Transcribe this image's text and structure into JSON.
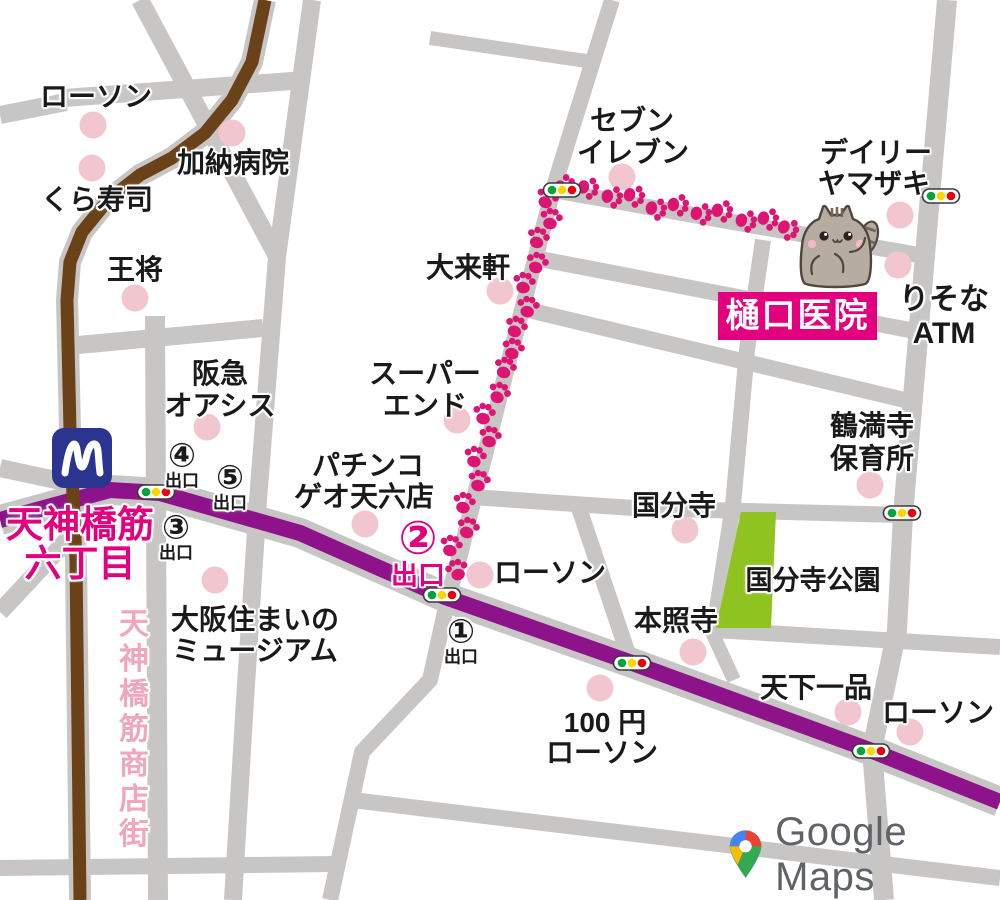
{
  "attribution": {
    "text": "Google Maps"
  },
  "station": {
    "line1": "天神橋筋",
    "line2": "六丁目",
    "metro_logo": "M"
  },
  "clinic": {
    "name": "樋口医院"
  },
  "park": {
    "name": "国分寺公園"
  },
  "arcade": {
    "chars": [
      "天",
      "神",
      "橋",
      "筋",
      "商",
      "店",
      "街"
    ]
  },
  "colors": {
    "road": "#C8C5C5",
    "purple_road": "#8E138B",
    "brown_road": "#6B4117",
    "paw": "#DD1474",
    "accent_pink": "#E3007F",
    "poi_dot": "#F2C6CE",
    "park_green": "#8FC31F",
    "metro_blue": "#2B3590",
    "arcade_pink": "#F0A6BC",
    "light_green": "#00A43B",
    "light_yellow": "#FFD500",
    "light_red": "#E60012",
    "google_gray": "#5F6368",
    "text": "#1A1A1A",
    "cat_body": "#B7ACA2",
    "cat_outline": "#51463C",
    "cat_stripe": "#74685C",
    "cat_cheek": "#F4B9C7"
  },
  "labels": [
    {
      "text": "ローソン",
      "x": 96,
      "y": 97
    },
    {
      "text": "加納病院",
      "x": 233,
      "y": 163
    },
    {
      "text": "くら寿司",
      "x": 97,
      "y": 200
    },
    {
      "text": "王将",
      "x": 135,
      "y": 270
    },
    {
      "text": "阪急",
      "x": 220,
      "y": 374
    },
    {
      "text": "オアシス",
      "x": 220,
      "y": 406
    },
    {
      "text": "スーパー",
      "x": 425,
      "y": 374
    },
    {
      "text": "エンド",
      "x": 425,
      "y": 406
    },
    {
      "text": "パチンコ",
      "x": 368,
      "y": 466
    },
    {
      "text": "ゲオ天六店",
      "x": 364,
      "y": 497
    },
    {
      "text": "大来軒",
      "x": 468,
      "y": 268
    },
    {
      "text": "セブン",
      "x": 632,
      "y": 121
    },
    {
      "text": "イレブン",
      "x": 633,
      "y": 153
    },
    {
      "text": "デイリー",
      "x": 876,
      "y": 153
    },
    {
      "text": "ヤマザキ",
      "x": 874,
      "y": 184
    },
    {
      "text": "りそな",
      "x": 944,
      "y": 300,
      "size": 30
    },
    {
      "text": "ATM",
      "x": 944,
      "y": 334,
      "size": 30
    },
    {
      "text": "鶴満寺",
      "x": 872,
      "y": 426
    },
    {
      "text": "保育所",
      "x": 872,
      "y": 459
    },
    {
      "text": "国分寺",
      "x": 674,
      "y": 506
    },
    {
      "text": "国分寺公園",
      "x": 813,
      "y": 581,
      "size": 27
    },
    {
      "text": "本照寺",
      "x": 676,
      "y": 621
    },
    {
      "text": "天下一品",
      "x": 816,
      "y": 688
    },
    {
      "text": "ローソン",
      "x": 938,
      "y": 713
    },
    {
      "text": "100 円",
      "x": 605,
      "y": 723
    },
    {
      "text": "ローソン",
      "x": 602,
      "y": 753
    },
    {
      "text": "大阪住まいの",
      "x": 255,
      "y": 620
    },
    {
      "text": "ミュージアム",
      "x": 255,
      "y": 651
    },
    {
      "text": "ローソン",
      "x": 550,
      "y": 573
    }
  ],
  "exits": [
    {
      "num": "④",
      "label": "出口",
      "x": 182,
      "y": 464,
      "variant": "black"
    },
    {
      "num": "⑤",
      "label": "出口",
      "x": 230,
      "y": 486,
      "variant": "black"
    },
    {
      "num": "③",
      "label": "出口",
      "x": 176,
      "y": 536,
      "variant": "black"
    },
    {
      "num": "②",
      "label": "出口",
      "x": 418,
      "y": 552,
      "variant": "pink"
    },
    {
      "num": "①",
      "label": "出口",
      "x": 461,
      "y": 640,
      "variant": "black"
    }
  ],
  "dots": [
    [
      93,
      125
    ],
    [
      92,
      168
    ],
    [
      232,
      133
    ],
    [
      135,
      298
    ],
    [
      207,
      427
    ],
    [
      457,
      420
    ],
    [
      365,
      524
    ],
    [
      500,
      291
    ],
    [
      622,
      177
    ],
    [
      900,
      215
    ],
    [
      898,
      265
    ],
    [
      870,
      485
    ],
    [
      685,
      530
    ],
    [
      693,
      652
    ],
    [
      215,
      580
    ],
    [
      848,
      712
    ],
    [
      910,
      732
    ],
    [
      600,
      688
    ],
    [
      480,
      575
    ]
  ],
  "traffic_lights": [
    [
      156,
      492
    ],
    [
      442,
      595
    ],
    [
      632,
      663
    ],
    [
      871,
      751
    ],
    [
      902,
      513
    ],
    [
      941,
      196
    ],
    [
      562,
      190
    ]
  ],
  "paw_route": [
    [
      457,
      570
    ],
    [
      451,
      546
    ],
    [
      468,
      528
    ],
    [
      464,
      503
    ],
    [
      479,
      481
    ],
    [
      475,
      457
    ],
    [
      490,
      437
    ],
    [
      484,
      414
    ],
    [
      499,
      393
    ],
    [
      505,
      368
    ],
    [
      513,
      349
    ],
    [
      516,
      327
    ],
    [
      528,
      307
    ],
    [
      524,
      283
    ],
    [
      537,
      263
    ],
    [
      538,
      238
    ],
    [
      551,
      219
    ],
    [
      547,
      198
    ],
    [
      565,
      186
    ],
    [
      588,
      188
    ],
    [
      612,
      197
    ],
    [
      634,
      196
    ],
    [
      656,
      209
    ],
    [
      678,
      205
    ],
    [
      701,
      214
    ],
    [
      722,
      211
    ],
    [
      746,
      221
    ],
    [
      768,
      219
    ],
    [
      788,
      229
    ]
  ]
}
